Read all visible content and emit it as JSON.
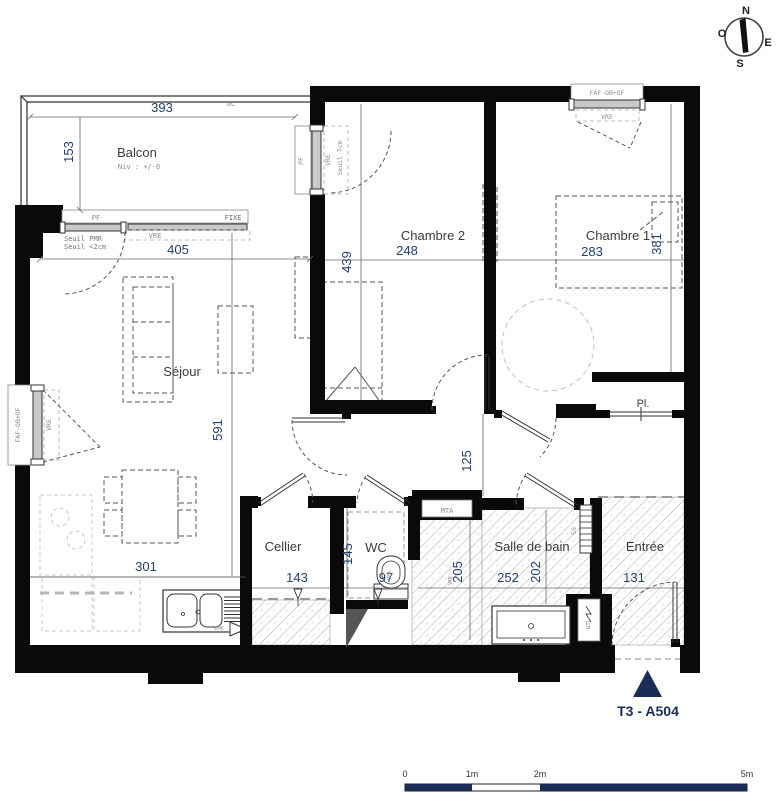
{
  "title": {
    "unit_label": "T3 - A504"
  },
  "compass": {
    "n": "N",
    "o": "O",
    "e": "E",
    "s": "S"
  },
  "rooms": {
    "balcon": {
      "name": "Balcon",
      "level": "Niv : +/-0",
      "dim_w": "393",
      "dim_h": "153"
    },
    "sejour": {
      "name": "Séjour",
      "dim_w": "405",
      "dim_h": "591",
      "dim_kitchen": "301"
    },
    "chambre2": {
      "name": "Chambre 2",
      "dim_w": "248",
      "dim_h": "439"
    },
    "chambre1": {
      "name": "Chambre 1",
      "dim_w": "283",
      "dim_h": "381"
    },
    "placard": {
      "name": "Pl."
    },
    "couloir": {
      "dim_h": "125"
    },
    "cellier": {
      "name": "Cellier",
      "dim_w": "143"
    },
    "wc": {
      "name": "WC",
      "dim_w": "97",
      "dim_h": "145"
    },
    "salle_de_bain": {
      "name": "Salle de bain",
      "dim_w": "252",
      "dim_h": "202",
      "dim_duct": "205"
    },
    "entree": {
      "name": "Entrée",
      "dim_w": "131"
    }
  },
  "annotations": {
    "gc": "GC",
    "pf": "PF",
    "fixe": "FIXE",
    "vre": "VRE",
    "faf": "FAF-OB+OF",
    "seuil_pmr": "Seuil PMR",
    "seuil_2cm": "Seuil <2cm",
    "seuil_7cm": "Seuil 7cm",
    "vmc": "VMC",
    "mta": "MTA",
    "ss": "SS",
    "gtl": "GTL"
  },
  "scale_bar": {
    "t0": "0",
    "t1": "1m",
    "t2": "2m",
    "t5": "5m"
  },
  "colors": {
    "wall": "#0a0a0a",
    "accent": "#1b2d56",
    "dim_text": "#24416b",
    "hatch": "#aaaaaa"
  }
}
